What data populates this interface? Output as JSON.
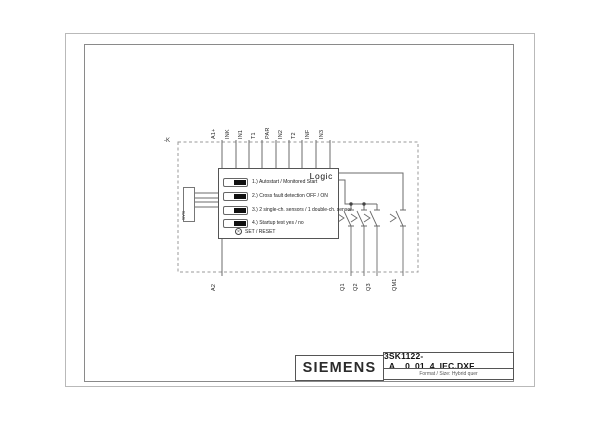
{
  "title_block": {
    "brand": "SIEMENS",
    "filename": "3SK1122-_A__0_01_4_IEC.DXF",
    "format_info": "Format / Size: Hybrid quer"
  },
  "schematic": {
    "device_tag": "-K",
    "logic_label": "Logic",
    "connector_label": "SYS",
    "set_reset_label": "SET / RESET",
    "top_terminals": [
      "A1+",
      "INK",
      "IN1",
      "T1",
      "PAR",
      "IN2",
      "T2",
      "INF",
      "IN3"
    ],
    "supply_return_terminal": "A2",
    "output_terminals": [
      "Q1",
      "Q2",
      "Q3",
      "QM1"
    ],
    "dip_switch_settings": [
      "1.) Autostart / Monitored Start",
      "2.) Cross fault detection OFF / ON",
      "3.) 2 single-ch. sensors / 1 double-ch. sensor",
      "4.) Startup test yes / no"
    ]
  },
  "colors": {
    "wire": "#6b6b6b",
    "dashed_boundary": "#999999",
    "frame_outer": "#b9b9b9",
    "frame_inner": "#8a8a8a",
    "text": "#1a1a1a",
    "background": "#ffffff"
  }
}
